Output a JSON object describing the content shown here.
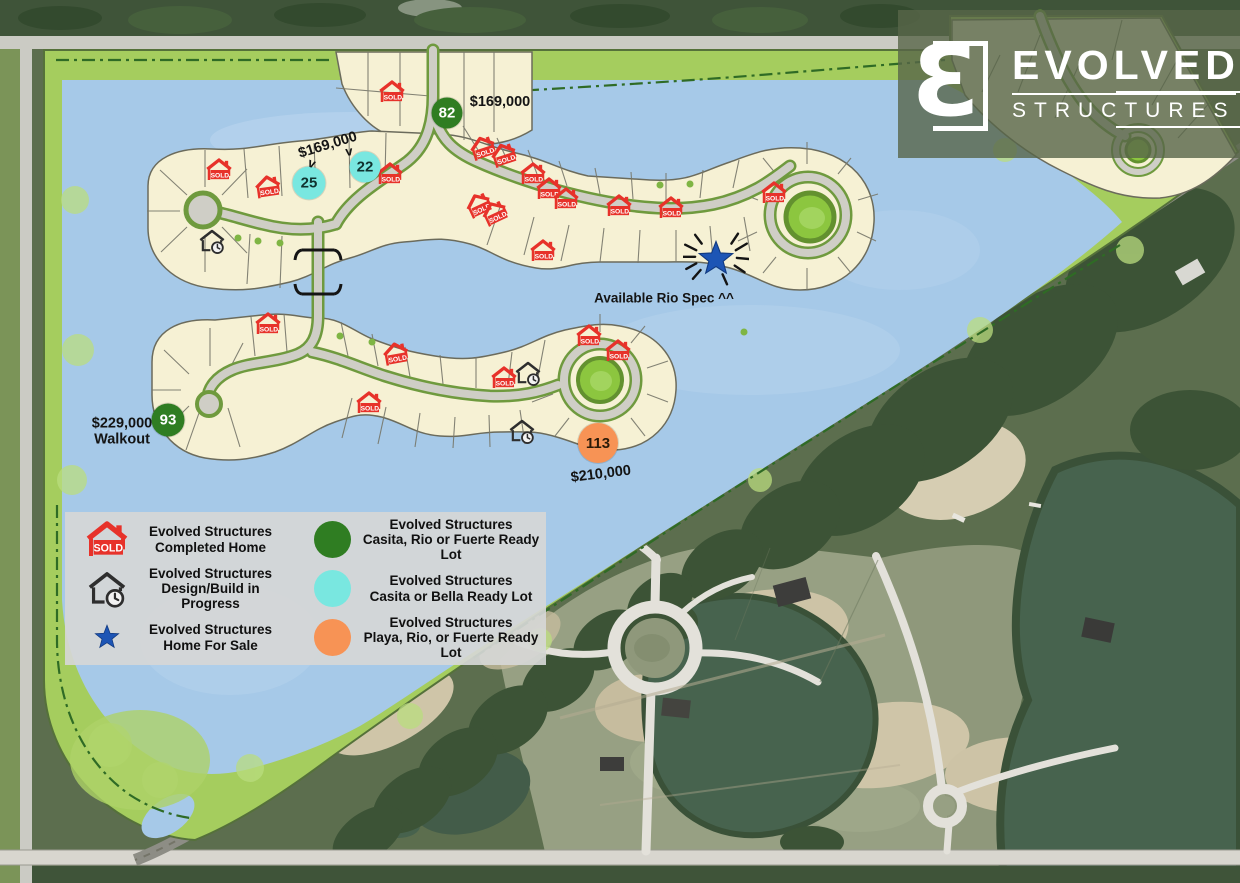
{
  "logo": {
    "mark_letter": "Ɛ",
    "brand_top": "EVOLVED",
    "brand_bottom": "STRUCTURES"
  },
  "legend": {
    "items": [
      {
        "icon": "sold-home",
        "line1": "Evolved Structures",
        "line2": "Completed Home"
      },
      {
        "icon": "green-dot",
        "line1": "Evolved Structures",
        "line2": "Casita, Rio or Fuerte Ready Lot"
      },
      {
        "icon": "design-build",
        "line1": "Evolved Structures",
        "line2": "Design/Build in Progress"
      },
      {
        "icon": "cyan-dot",
        "line1": "Evolved Structures",
        "line2": "Casita or Bella Ready Lot"
      },
      {
        "icon": "star",
        "line1": "Evolved Structures",
        "line2": "Home For Sale"
      },
      {
        "icon": "orange-dot",
        "line1": "Evolved Structures",
        "line2": "Playa, Rio, or Fuerte Ready Lot"
      }
    ]
  },
  "map": {
    "sold_label": "SOLD",
    "colors": {
      "lot_green": "#2f7d22",
      "lot_cyan": "#79e7e0",
      "lot_orange": "#f79355",
      "sold_red": "#e7322a",
      "star_blue": "#1d55b5"
    },
    "lot_markers": [
      {
        "value": "82",
        "color": "green",
        "x": 447,
        "y": 113,
        "d": 31
      },
      {
        "value": "25",
        "color": "cyan",
        "x": 309,
        "y": 183,
        "d": 33
      },
      {
        "value": "22",
        "color": "cyan",
        "x": 365,
        "y": 167,
        "d": 31
      },
      {
        "value": "93",
        "color": "green",
        "x": 168,
        "y": 420,
        "d": 33
      },
      {
        "value": "113",
        "color": "orange",
        "x": 598,
        "y": 443,
        "d": 40
      }
    ],
    "sold_markers": [
      {
        "x": 392,
        "y": 92
      },
      {
        "x": 219,
        "y": 170
      },
      {
        "x": 268,
        "y": 187,
        "rot": -8
      },
      {
        "x": 390,
        "y": 174
      },
      {
        "x": 483,
        "y": 148,
        "rot": -18
      },
      {
        "x": 504,
        "y": 155,
        "rot": -18
      },
      {
        "x": 533,
        "y": 174
      },
      {
        "x": 549,
        "y": 189
      },
      {
        "x": 566,
        "y": 199
      },
      {
        "x": 479,
        "y": 205,
        "rot": -25
      },
      {
        "x": 495,
        "y": 213,
        "rot": -25
      },
      {
        "x": 619,
        "y": 206
      },
      {
        "x": 671,
        "y": 208
      },
      {
        "x": 774,
        "y": 193
      },
      {
        "x": 543,
        "y": 251
      },
      {
        "x": 268,
        "y": 324
      },
      {
        "x": 396,
        "y": 354,
        "rot": -10
      },
      {
        "x": 369,
        "y": 403
      },
      {
        "x": 589,
        "y": 336
      },
      {
        "x": 618,
        "y": 351
      },
      {
        "x": 504,
        "y": 378
      }
    ],
    "design_markers": [
      {
        "x": 212,
        "y": 241
      },
      {
        "x": 528,
        "y": 373
      },
      {
        "x": 522,
        "y": 431
      }
    ],
    "star_markers": [
      {
        "x": 716,
        "y": 259
      }
    ],
    "labels": [
      {
        "kind": "price",
        "text": "$169,000",
        "x": 500,
        "y": 103
      },
      {
        "kind": "price",
        "text": "$169,000",
        "x": 328,
        "y": 146,
        "rot": -17
      },
      {
        "kind": "arrow",
        "text": "v",
        "x": 312,
        "y": 163,
        "rot": 20
      },
      {
        "kind": "arrow",
        "text": "v",
        "x": 349,
        "y": 151,
        "rot": -8
      },
      {
        "kind": "price",
        "text": "$229,000\nWalkout",
        "x": 122,
        "y": 432
      },
      {
        "kind": "price",
        "text": "$210,000",
        "x": 601,
        "y": 475,
        "rot": -7
      },
      {
        "kind": "note",
        "text": "Available Rio Spec ^^",
        "x": 664,
        "y": 298
      }
    ]
  }
}
